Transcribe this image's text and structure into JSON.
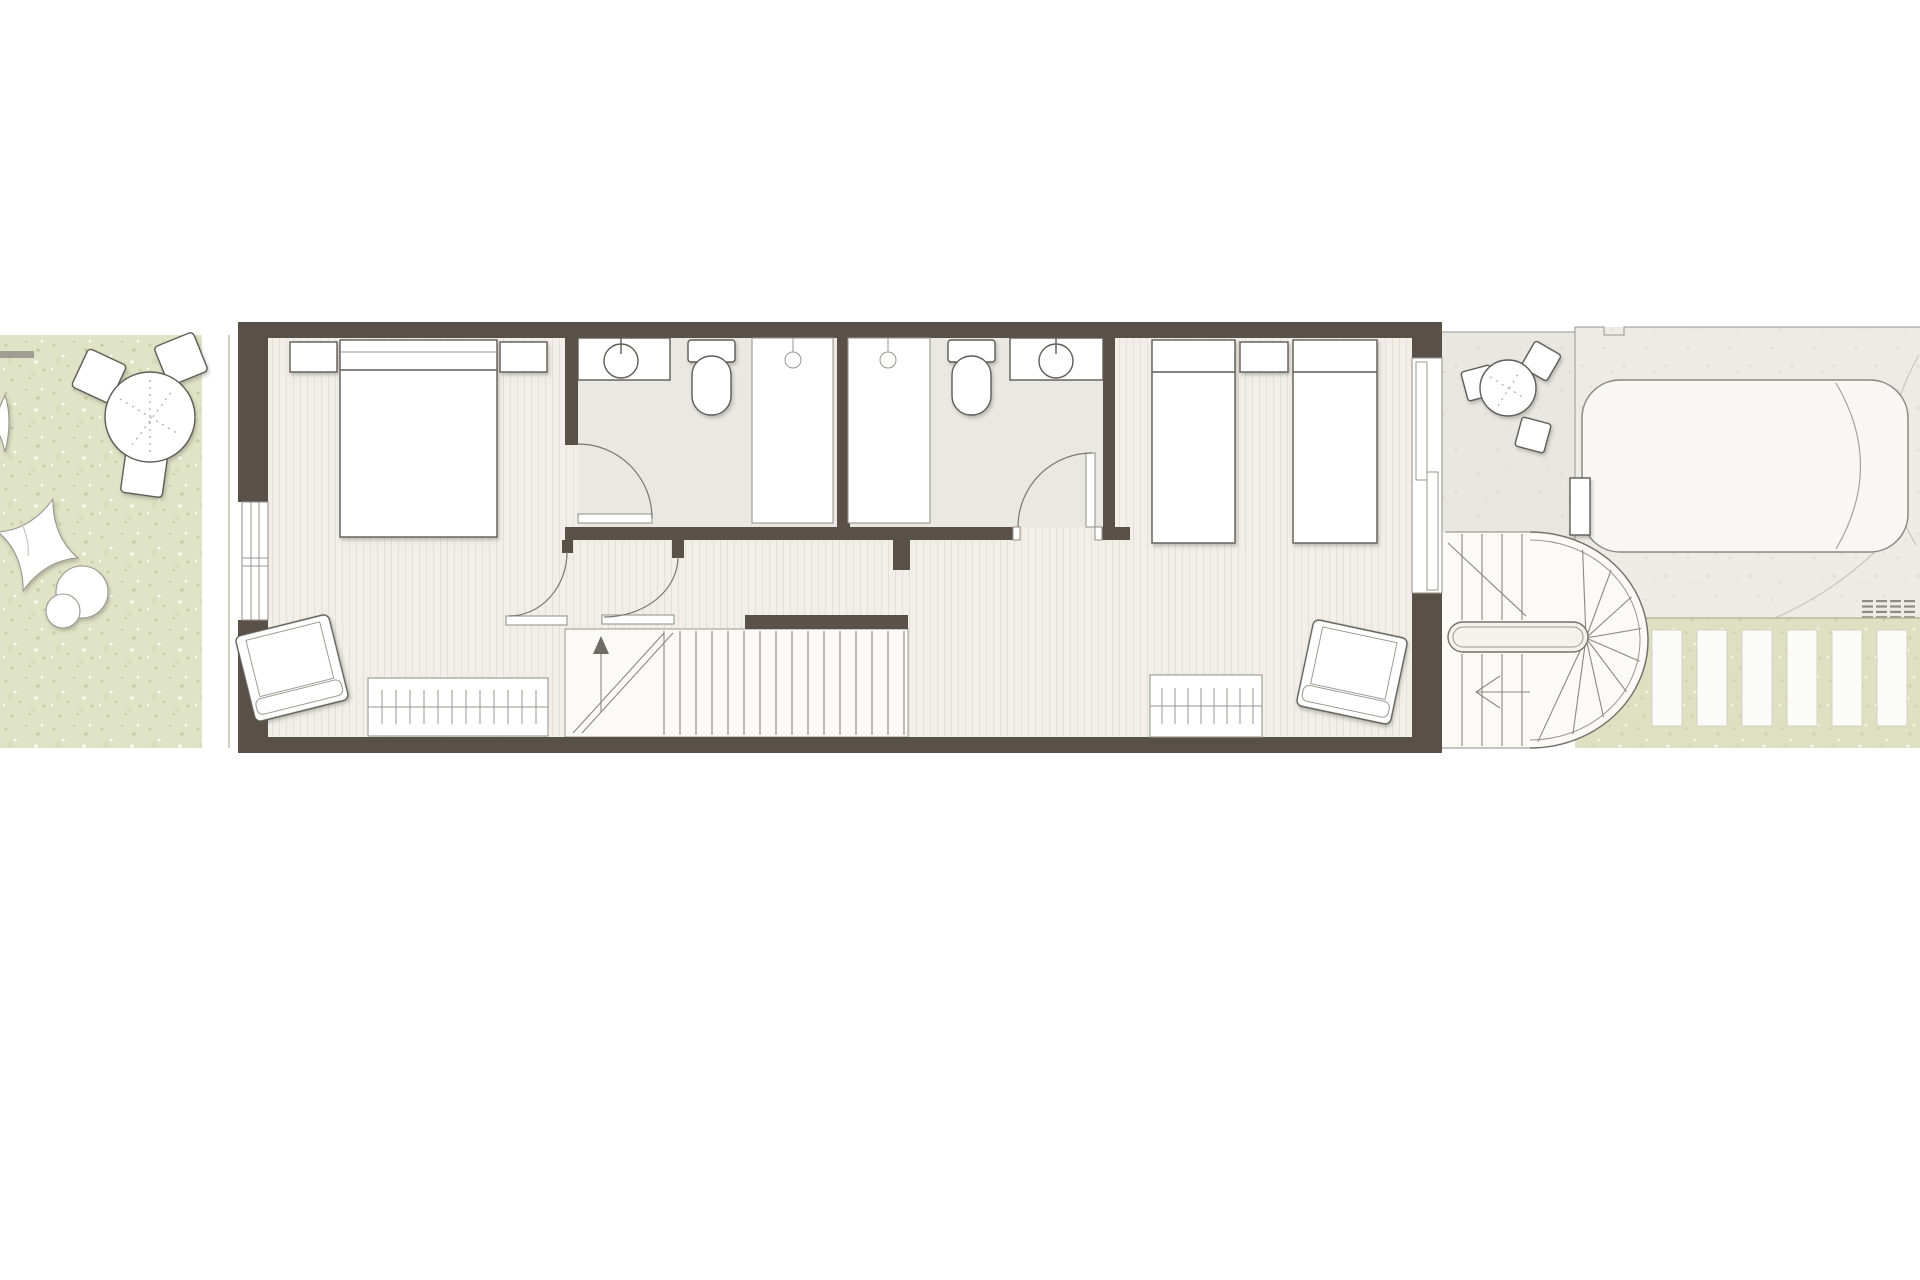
{
  "document": {
    "kind": "architectural floor plan, upper storey of a narrow terraced house, top view, no text labels"
  },
  "colors": {
    "wall": "#595047",
    "line": "#5f5b55",
    "line_light": "#9a968e",
    "floor_wood": "#f1efe8",
    "floor_stripe": "#e3e1d6",
    "bath_floor": "#eae8e3",
    "stair_floor": "#fbfaf7",
    "garden_green": "#e0e4c6",
    "speckle_dark": "#c6cda3",
    "green_strip": "#dde1c2",
    "terrace": "#e9e7e1",
    "driveway": "#edebe6",
    "car_fill": "#f8f7f3",
    "furniture_fill": "#ffffff"
  },
  "plan": {
    "rooms": [
      {
        "name": "garden-left"
      },
      {
        "name": "master-bedroom"
      },
      {
        "name": "ensuite-bathroom"
      },
      {
        "name": "family-bathroom"
      },
      {
        "name": "twin-bedroom"
      },
      {
        "name": "hallway"
      },
      {
        "name": "internal-staircase"
      },
      {
        "name": "terrace"
      },
      {
        "name": "external-curved-staircase"
      },
      {
        "name": "driveway"
      },
      {
        "name": "garden-path-right"
      }
    ],
    "furniture": [
      "round-garden-table",
      "garden-chair x3",
      "beanbag-pillow x2",
      "pouf x2",
      "double-bed",
      "nightstand x3",
      "armchair x2",
      "radiator x2",
      "washbasin-counter x2",
      "toilet x2",
      "shower-tray x2",
      "shower-head x2",
      "single-bed x2",
      "round-terrace-table",
      "terrace-chair x3",
      "car"
    ]
  },
  "repeats": {
    "internal_stair_treads": 16,
    "external_stair_straight_treads_per_flight": 4,
    "external_stair_fan_treads": 9,
    "garden_path_pavers": 6,
    "radiator_ticks_master": 12,
    "radiator_ticks_twin": 8,
    "car_grille_rows": 4,
    "car_grille_cols": 4,
    "garden_chairs": 3,
    "terrace_chairs": 3
  }
}
